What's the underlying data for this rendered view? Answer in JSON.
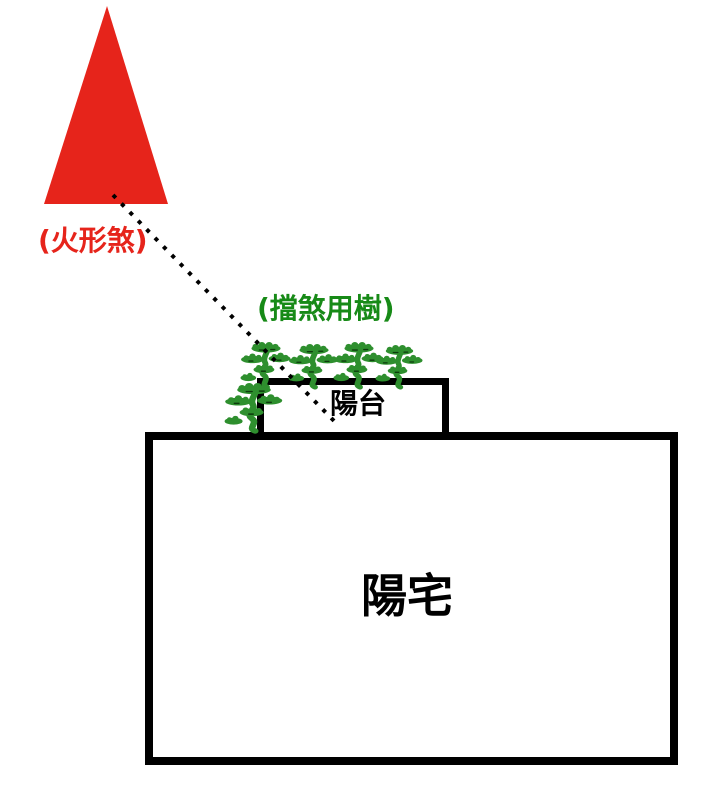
{
  "diagram": {
    "background_color": "#ffffff",
    "labels": {
      "fire_sha": "(火形煞)",
      "blocking_trees": "(擋煞用樹)",
      "balcony": "陽台",
      "house": "陽宅"
    },
    "colors": {
      "sha_red": "#e6241b",
      "label_green": "#178a17",
      "tree_green": "#2e8f2e",
      "tree_accent_dark": "#0c3b0c",
      "outline_black": "#000000"
    }
  }
}
